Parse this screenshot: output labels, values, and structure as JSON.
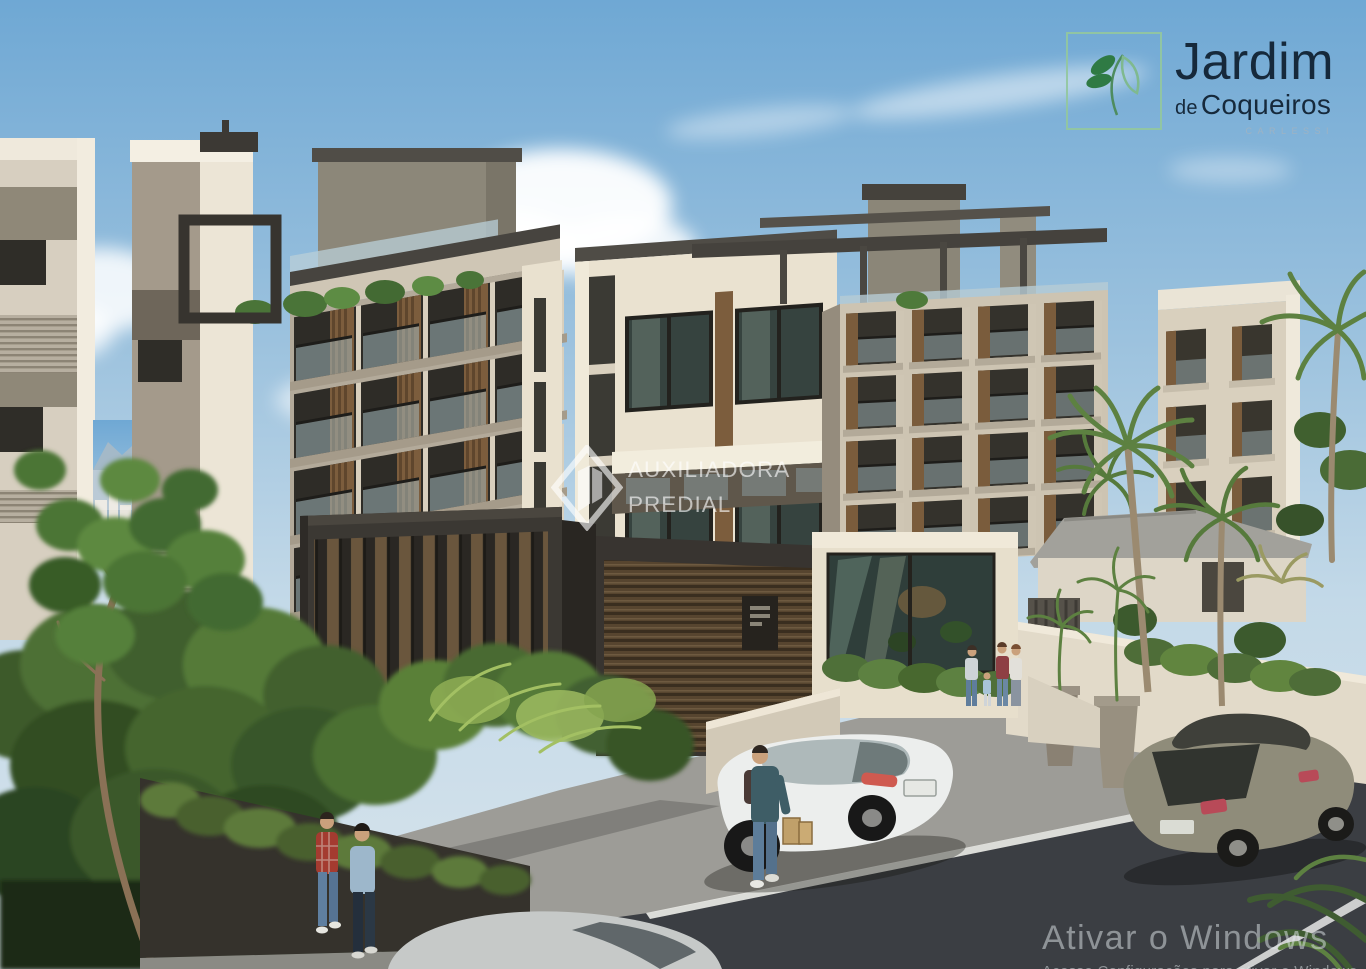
{
  "brand_logo": {
    "title": "Jardim",
    "subtitle_prefix": "de",
    "subtitle": "Coqueiros",
    "tagline": "CARLESSI",
    "icon": "leaf-sprig-icon",
    "frame_color": "#92c79e",
    "leaf_color": "#2f7a44",
    "text_color": "#16293b"
  },
  "watermark": {
    "line1": "AUXILIADORA",
    "line2": "PREDIAL",
    "icon": "diamond-building-icon",
    "color": "#ffffff"
  },
  "windows_activation": {
    "title": "Ativar o Windows",
    "subtitle": "Acesse Configurações para ativar o Windows",
    "color": "#dfe3e6"
  }
}
